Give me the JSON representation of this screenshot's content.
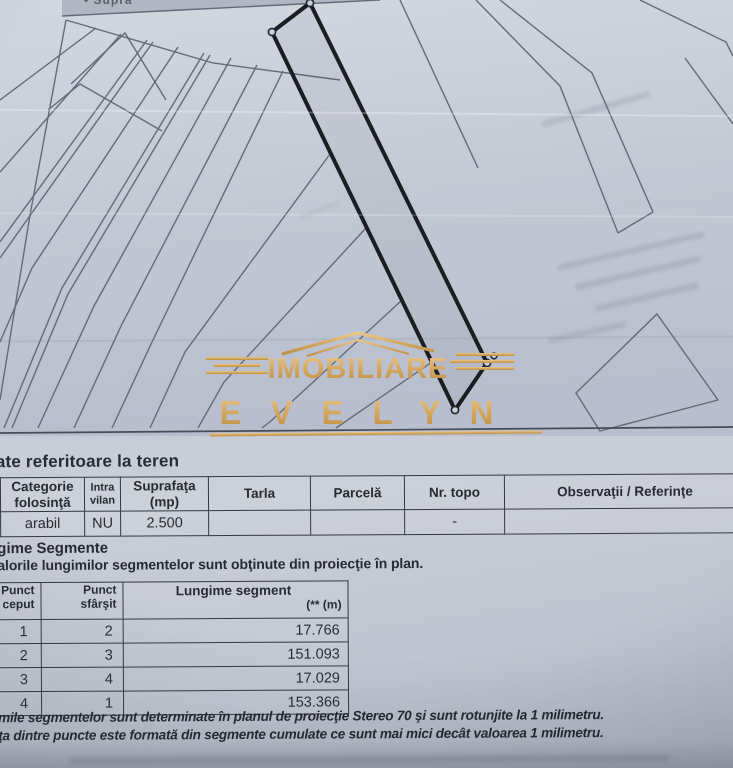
{
  "map": {
    "top_partial_label": "• Supra",
    "subject_parcel": {
      "corners": [
        "1",
        "2",
        "3",
        "4"
      ],
      "outline_color": "#1b1d21"
    }
  },
  "watermark": {
    "line1": "IMOBILIARE",
    "line2": "EVELYN",
    "color": "#d9a757"
  },
  "teren": {
    "title": "ate referitoare la teren",
    "columns": [
      "Categorie folosinţă",
      "Intra vilan",
      "Suprafaţa (mp)",
      "Tarla",
      "Parcelă",
      "Nr. topo",
      "Observaţii / Referinţe"
    ],
    "row": {
      "categorie": "arabil",
      "intravilan": "NU",
      "suprafata": "2.500",
      "tarla": "",
      "parcela": "",
      "nr_topo": "-",
      "observatii": ""
    }
  },
  "segmente": {
    "title": "gime Segmente",
    "subtitle": "alorile lungimilor segmentelor sunt obţinute din proiecţie în plan.",
    "col1_line1": "Punct",
    "col1_line2": "ceput",
    "col2_line1": "Punct",
    "col2_line2": "sfârşit",
    "col3_line1": "Lungime segment",
    "col3_line2": "(** (m)",
    "rows": [
      {
        "start": "1",
        "end": "2",
        "len": "17.766"
      },
      {
        "start": "2",
        "end": "3",
        "len": "151.093"
      },
      {
        "start": "3",
        "end": "4",
        "len": "17.029"
      },
      {
        "start": "4",
        "end": "1",
        "len": "153.366"
      }
    ],
    "footnote1": "mile segmentelor sunt determinate în planul de proiecţie Stereo 70 şi sunt rotunjite la 1 milimetru.",
    "footnote2": "ţa dintre puncte este formată din segmente cumulate ce sunt mai mici decât valoarea 1 milimetru."
  }
}
